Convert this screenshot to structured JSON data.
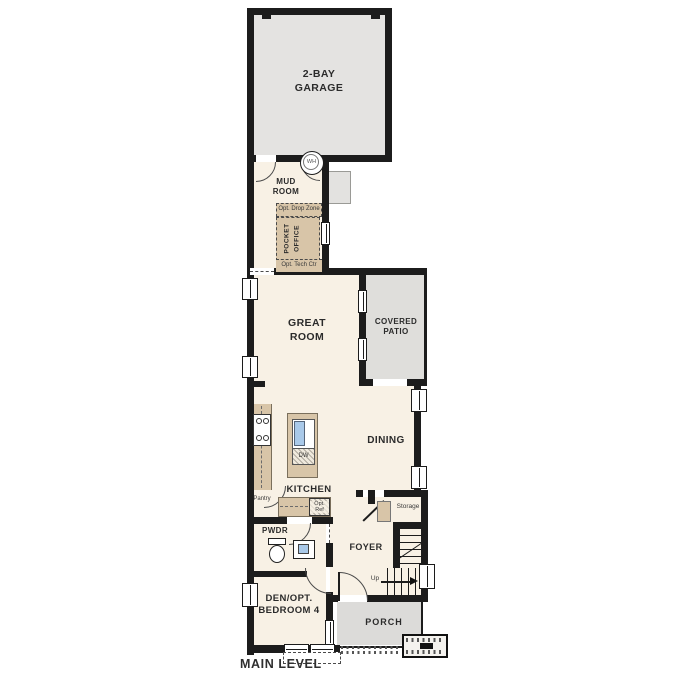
{
  "plan": {
    "level_label": "MAIN LEVEL"
  },
  "rooms": {
    "garage": {
      "line1": "2-BAY",
      "line2": "GARAGE"
    },
    "mud_room": {
      "line1": "MUD",
      "line2": "ROOM"
    },
    "drop_zone": {
      "label": "Opt. Drop Zone"
    },
    "pocket_office": {
      "line1": "POCKET",
      "line2": "OFFICE"
    },
    "tech_center": {
      "label": "Opt. Tech Ctr"
    },
    "great_room": {
      "line1": "GREAT",
      "line2": "ROOM"
    },
    "covered_patio": {
      "line1": "COVERED",
      "line2": "PATIO"
    },
    "dining": {
      "label": "DINING"
    },
    "kitchen": {
      "label": "KITCHEN"
    },
    "pantry": {
      "label": "Pantry"
    },
    "powder": {
      "label": "PWDR"
    },
    "foyer": {
      "label": "FOYER"
    },
    "storage": {
      "label": "Storage"
    },
    "porch": {
      "label": "PORCH"
    },
    "den": {
      "line1": "DEN/OPT.",
      "line2": "BEDROOM 4"
    }
  },
  "fixtures": {
    "water_heater": "WH",
    "dishwasher": "DW",
    "opt_ref": {
      "line1": "Opt.",
      "line2": "Ref"
    },
    "stairs_up": "Up"
  },
  "colors": {
    "wall": "#1c1c1c",
    "interior_floor": "#f8f1e5",
    "garage_floor": "#e4e3e1",
    "patio_floor": "#dfdedb",
    "cabinet": "#d8c5a8",
    "sink": "#a9c9e9"
  }
}
